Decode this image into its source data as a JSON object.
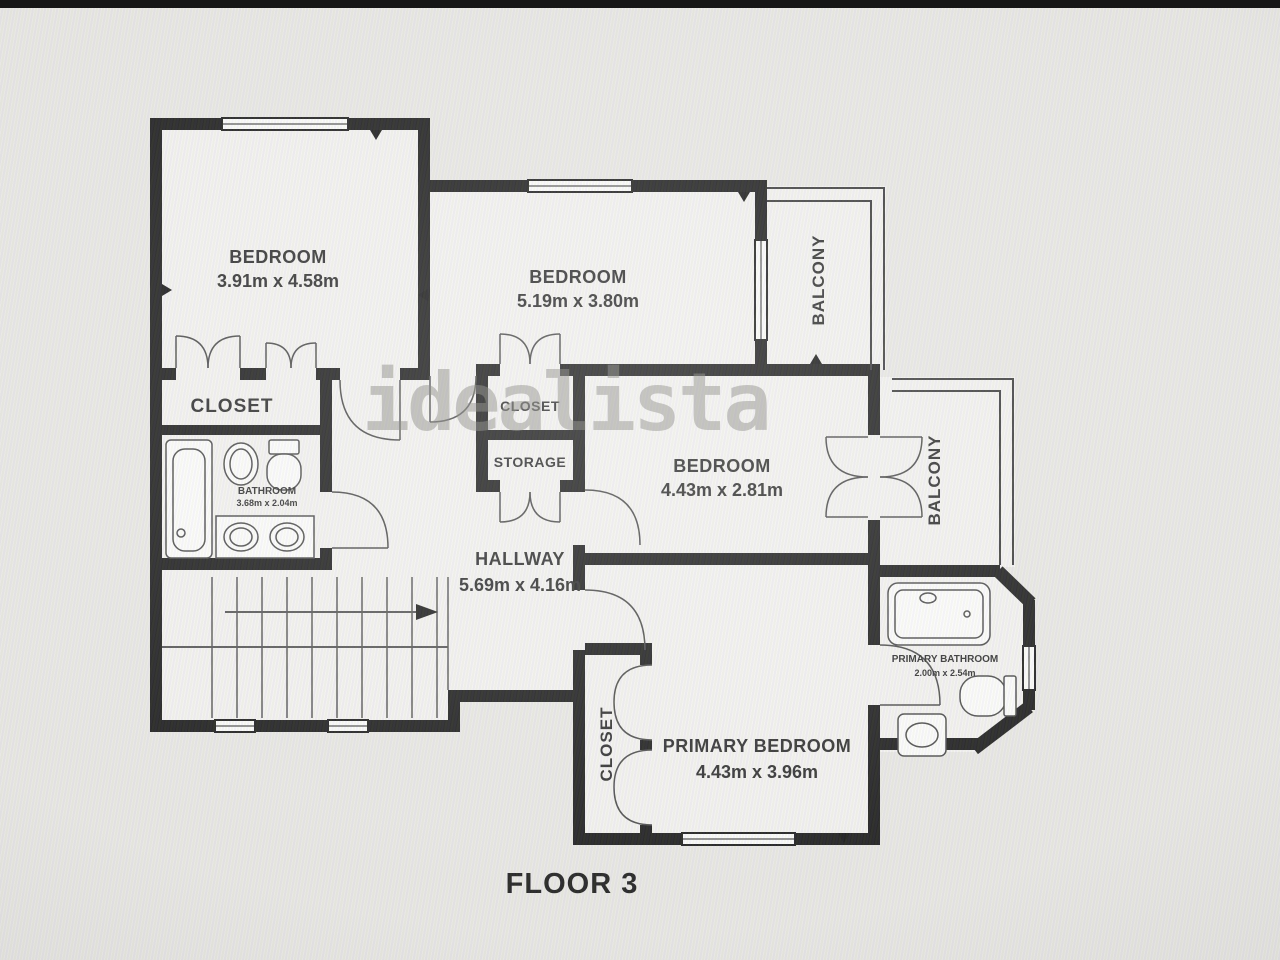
{
  "colors": {
    "wall": "#1c1c1c",
    "floor": "#f2f1ef",
    "background": "#e8e7e4",
    "label_text": "#2d2d2d",
    "watermark": "#7d7d7a"
  },
  "labels": {
    "watermark": "idealista",
    "floor_caption": "FLOOR 3",
    "bedroom1": {
      "name": "BEDROOM",
      "dims": "3.91m x 4.58m"
    },
    "bedroom2": {
      "name": "BEDROOM",
      "dims": "5.19m x 3.80m"
    },
    "bedroom3": {
      "name": "BEDROOM",
      "dims": "4.43m x 2.81m"
    },
    "primary_bedroom": {
      "name": "PRIMARY BEDROOM",
      "dims": "4.43m x 3.96m"
    },
    "hallway": {
      "name": "HALLWAY",
      "dims": "5.69m x 4.16m"
    },
    "bathroom": {
      "name": "BATHROOM",
      "dims": "3.68m x 2.04m"
    },
    "primary_bathroom": {
      "name": "PRIMARY BATHROOM",
      "dims": "2.00m x 2.54m"
    },
    "closet_left": {
      "name": "CLOSET"
    },
    "closet_mid": {
      "name": "CLOSET"
    },
    "storage": {
      "name": "STORAGE"
    },
    "closet_primary": {
      "name": "CLOSET"
    },
    "balcony_top": {
      "name": "BALCONY"
    },
    "balcony_mid": {
      "name": "BALCONY"
    }
  }
}
